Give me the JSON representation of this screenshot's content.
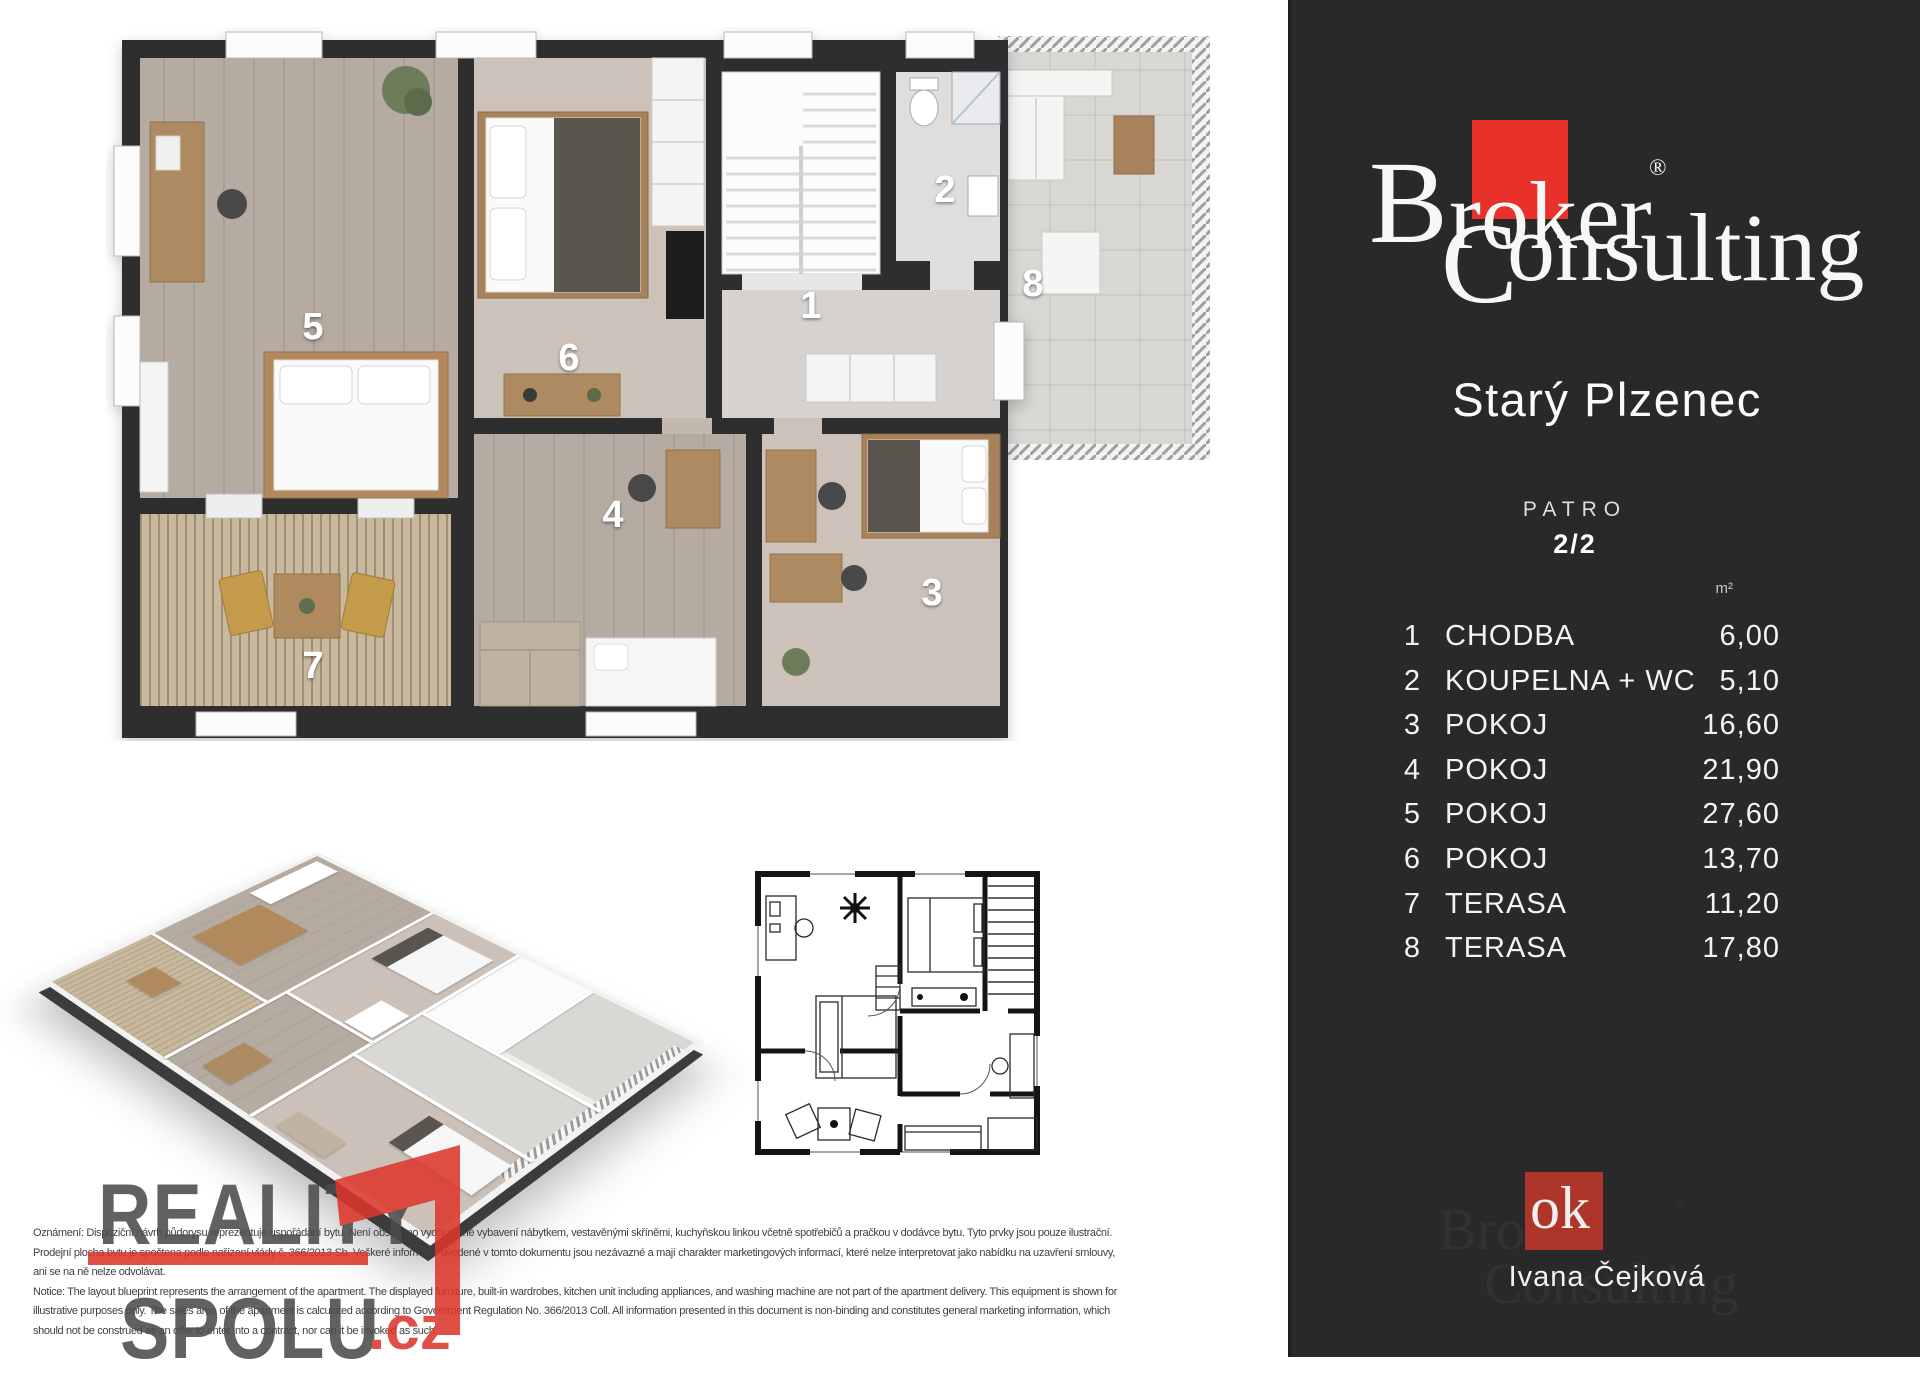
{
  "panel": {
    "brand": {
      "b": "B",
      "roker": "roker",
      "registered": "®",
      "c": "C",
      "onsulting": "onsulting",
      "ok_text": "ok"
    },
    "title": "Starý Plzenec",
    "floor_label": "PATRO",
    "floor_value": "2/2",
    "area_unit": "m²",
    "rooms": [
      {
        "num": "1",
        "name": "CHODBA",
        "area": "6,00"
      },
      {
        "num": "2",
        "name": "KOUPELNA + WC",
        "area": "5,10"
      },
      {
        "num": "3",
        "name": "POKOJ",
        "area": "16,60"
      },
      {
        "num": "4",
        "name": "POKOJ",
        "area": "21,90"
      },
      {
        "num": "5",
        "name": "POKOJ",
        "area": "27,60"
      },
      {
        "num": "6",
        "name": "POKOJ",
        "area": "13,70"
      },
      {
        "num": "7",
        "name": "TERASA",
        "area": "11,20"
      },
      {
        "num": "8",
        "name": "TERASA",
        "area": "17,80"
      }
    ],
    "agent": {
      "name": "Ivana Čejková",
      "ok_text": "ok",
      "ghost_line1": "Broker",
      "ghost_line2": "Consulting",
      "registered": "®"
    }
  },
  "plan": {
    "labels": {
      "r1": "1",
      "r2": "2",
      "r3": "3",
      "r4": "4",
      "r5": "5",
      "r6": "6",
      "r7": "7",
      "r8": "8"
    }
  },
  "watermark": {
    "word1": "REALITY",
    "word2": "SPOLU",
    "suffix": ".cz"
  },
  "disclaimer": {
    "lines": [
      "Oznámení: Dispoziční návrh půdorysu reprezentuje uspořádání bytu. Není obsaženo vyobrazené vybavení nábytkem, vestavěnými skříněmi, kuchyňskou linkou včetně spotřebičů a pračkou v dodávce bytu. Tyto prvky jsou pouze ilustrační.",
      "Prodejní plocha bytu je spočtena podle nařízení vlády č. 366/2013 Sb. Veškeré informace uvedené v tomto dokumentu jsou nezávazné a mají charakter marketingových informací, které nelze interpretovat jako nabídku na uzavření smlouvy,",
      "ani se na ně nelze odvolávat.",
      "Notice: The layout blueprint represents the arrangement of the apartment. The displayed furniture, built-in wardrobes, kitchen unit including appliances, and washing machine are not part of the apartment delivery. This equipment is shown for",
      "illustrative purposes only. The sales area of the apartment is calculated according to Government Regulation No. 366/2013 Coll. All information presented in this document is non-binding and constitutes general marketing information, which",
      "should not be construed as an offer to enter into a contract, nor can it be invoked as such."
    ]
  },
  "colors": {
    "brand_red": "#e7312a",
    "agent_red": "#ae352a",
    "panel_bg": "#292929",
    "wall_dark": "#2f2f2f",
    "watermark_gray": "#4c4c4c",
    "watermark_red": "#dc372d"
  }
}
